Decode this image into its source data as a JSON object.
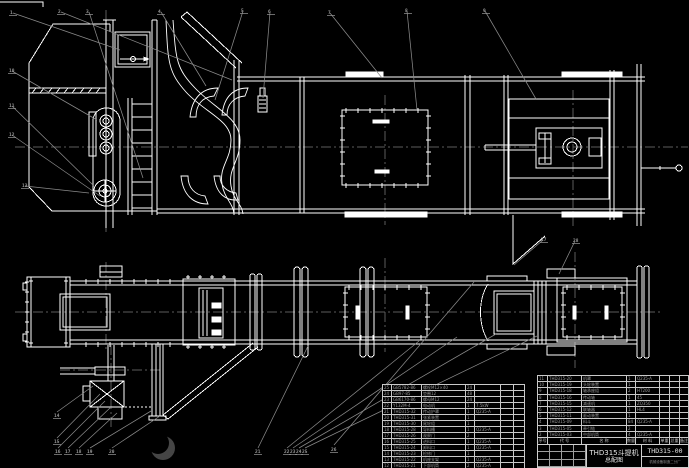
{
  "drawing": {
    "bg_color": "#000000",
    "geometry_color": "#ffffff",
    "leader_color": "#8a8a8a",
    "centerline_color": "#5c5c5c",
    "watermark": {
      "shape": "crescent-logo",
      "color": "#454545"
    },
    "views": {
      "top": "elevation-section-view",
      "bottom": "plan-view"
    }
  },
  "title_block": {
    "product": "THD315斗提机",
    "drawing_name": "总配图",
    "drawing_no": "THD315-00",
    "company": "机械设备制造二分厂"
  },
  "bom_right": {
    "header": [
      "序号",
      "代 号",
      "名 称",
      "数量",
      "材 料",
      "单重",
      "总重",
      "备注"
    ],
    "rows": [
      [
        "11",
        "THD315-20",
        "机罩",
        "1",
        "Q235-A",
        "",
        "",
        ""
      ],
      [
        "10",
        "THD315-19",
        "头轮装置",
        "1",
        "",
        "",
        "",
        ""
      ],
      [
        "9",
        "THD315-18",
        "轴承座组",
        "2",
        "HT200",
        "",
        "",
        ""
      ],
      [
        "8",
        "THD315-16",
        "传动轴",
        "1",
        "45",
        "",
        "",
        ""
      ],
      [
        "7",
        "THD315-15",
        "减速机",
        "1",
        "ZQ350",
        "",
        "",
        ""
      ],
      [
        "6",
        "THD315-12",
        "联轴器",
        "1",
        "HL4",
        "",
        "",
        ""
      ],
      [
        "5",
        "THD315-11",
        "驱动装置",
        "1",
        "",
        "",
        "",
        ""
      ],
      [
        "4",
        "THD315-09",
        "料斗",
        "84",
        "Q235-A",
        "",
        "",
        ""
      ],
      [
        "3",
        "THD315-05",
        "牵引链",
        "2",
        "",
        "",
        "",
        ""
      ],
      [
        "2",
        "THD315-03",
        "中部机筒",
        "4",
        "Q235-A",
        "",
        "",
        ""
      ]
    ]
  },
  "bom_left": {
    "rows": [
      [
        "25",
        "GB5782-86",
        "螺栓M12×40",
        "24",
        "",
        "",
        ""
      ],
      [
        "24",
        "GB97-85",
        "垫圈12",
        "48",
        "",
        "",
        ""
      ],
      [
        "23",
        "GB6170-86",
        "螺母M12",
        "24",
        "",
        "",
        ""
      ],
      [
        "22",
        "Y132M-4",
        "电动机",
        "1",
        "7.5kW",
        "",
        ""
      ],
      [
        "21",
        "THD315-32",
        "传动护罩",
        "1",
        "Q235-A",
        "",
        ""
      ],
      [
        "20",
        "THD315-31",
        "张紧装置",
        "1",
        "",
        "",
        ""
      ],
      [
        "19",
        "THD315-30",
        "尾轮组",
        "1",
        "",
        "",
        ""
      ],
      [
        "18",
        "THD315-28",
        "导料槽",
        "1",
        "Q235-A",
        "",
        ""
      ],
      [
        "17",
        "THD315-26",
        "观察门",
        "2",
        "",
        "",
        ""
      ],
      [
        "16",
        "THD315-25",
        "进料口",
        "1",
        "Q235-A",
        "",
        ""
      ],
      [
        "15",
        "THD315-24",
        "卸料口",
        "1",
        "Q235-A",
        "",
        ""
      ],
      [
        "14",
        "THD315-23",
        "检修门",
        "1",
        "",
        "",
        ""
      ],
      [
        "13",
        "THD315-22",
        "机座支架",
        "1",
        "Q235-A",
        "",
        ""
      ],
      [
        "12",
        "THD315-21",
        "下部机筒",
        "2",
        "Q235-A",
        "",
        ""
      ]
    ]
  },
  "callouts": [
    {
      "n": "1",
      "x": 10,
      "y": 10
    },
    {
      "n": "2",
      "x": 58,
      "y": 9
    },
    {
      "n": "3",
      "x": 86,
      "y": 9
    },
    {
      "n": "4",
      "x": 158,
      "y": 9
    },
    {
      "n": "5",
      "x": 241,
      "y": 8
    },
    {
      "n": "6",
      "x": 268,
      "y": 9
    },
    {
      "n": "7",
      "x": 328,
      "y": 10
    },
    {
      "n": "8",
      "x": 405,
      "y": 8
    },
    {
      "n": "9",
      "x": 483,
      "y": 8
    },
    {
      "n": "10",
      "x": 9,
      "y": 68
    },
    {
      "n": "11",
      "x": 9,
      "y": 103
    },
    {
      "n": "12",
      "x": 9,
      "y": 132
    },
    {
      "n": "13",
      "x": 22,
      "y": 183
    },
    {
      "n": "14",
      "x": 54,
      "y": 413
    },
    {
      "n": "15",
      "x": 54,
      "y": 439
    },
    {
      "n": "16",
      "x": 55,
      "y": 449
    },
    {
      "n": "17",
      "x": 65,
      "y": 449
    },
    {
      "n": "18",
      "x": 76,
      "y": 449
    },
    {
      "n": "19",
      "x": 87,
      "y": 449
    },
    {
      "n": "20",
      "x": 109,
      "y": 449
    },
    {
      "n": "21",
      "x": 255,
      "y": 449
    },
    {
      "n": "22",
      "x": 284,
      "y": 449
    },
    {
      "n": "23",
      "x": 290,
      "y": 449
    },
    {
      "n": "24",
      "x": 296,
      "y": 449
    },
    {
      "n": "25",
      "x": 302,
      "y": 449
    },
    {
      "n": "26",
      "x": 331,
      "y": 447
    },
    {
      "n": "27",
      "x": 541,
      "y": 237
    },
    {
      "n": "28",
      "x": 573,
      "y": 238
    }
  ],
  "leaders": [
    [
      13,
      13,
      120,
      50
    ],
    [
      61,
      12,
      232,
      80
    ],
    [
      89,
      12,
      143,
      178
    ],
    [
      161,
      12,
      206,
      86
    ],
    [
      243,
      11,
      215,
      100
    ],
    [
      270,
      12,
      263,
      98
    ],
    [
      330,
      13,
      382,
      78
    ],
    [
      407,
      11,
      417,
      110
    ],
    [
      485,
      11,
      536,
      99
    ],
    [
      12,
      71,
      97,
      120
    ],
    [
      12,
      106,
      95,
      187
    ],
    [
      12,
      135,
      100,
      196
    ],
    [
      25,
      186,
      89,
      193
    ],
    [
      57,
      412,
      93,
      386
    ],
    [
      57,
      438,
      100,
      394
    ],
    [
      58,
      448,
      105,
      401
    ],
    [
      68,
      448,
      111,
      407
    ],
    [
      79,
      448,
      117,
      413
    ],
    [
      90,
      448,
      151,
      411
    ],
    [
      112,
      448,
      160,
      416
    ],
    [
      258,
      448,
      308,
      346
    ],
    [
      287,
      448,
      419,
      341
    ],
    [
      293,
      448,
      457,
      337
    ],
    [
      299,
      448,
      496,
      334
    ],
    [
      305,
      448,
      537,
      336
    ],
    [
      334,
      445,
      474,
      282
    ],
    [
      543,
      240,
      514,
      265
    ],
    [
      575,
      241,
      559,
      274
    ]
  ]
}
